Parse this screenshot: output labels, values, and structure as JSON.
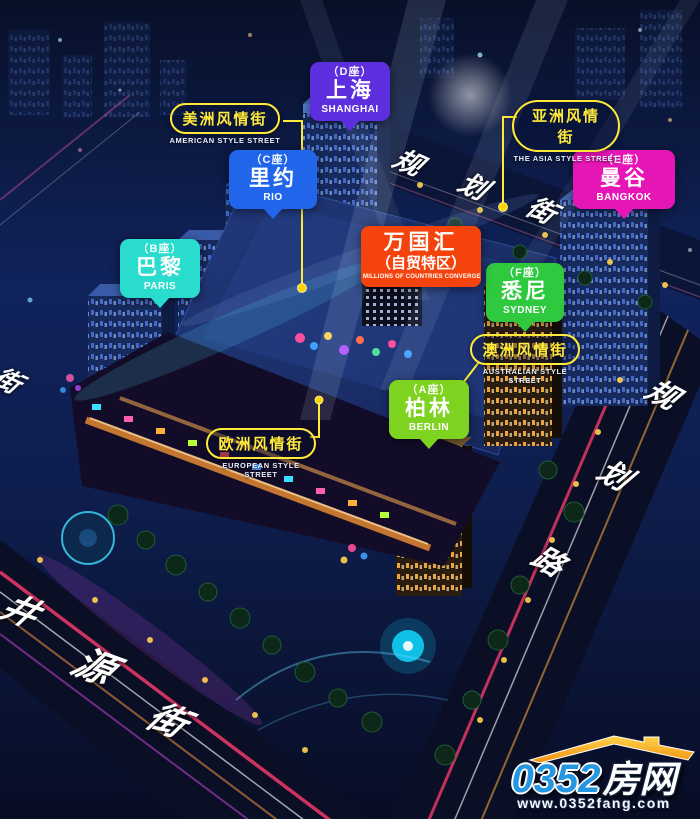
{
  "building_labels": {
    "shanghai": {
      "block": "（D座）",
      "name": "上海",
      "en": "SHANGHAI",
      "color": "#5c2ede"
    },
    "rio": {
      "block": "（C座）",
      "name": "里约",
      "en": "RIO",
      "color": "#2166ea"
    },
    "bangkok": {
      "block": "（E座）",
      "name": "曼谷",
      "en": "BANGKOK",
      "color": "#e615b5"
    },
    "paris": {
      "block": "（B座）",
      "name": "巴黎",
      "en": "PARIS",
      "color": "#29dccd"
    },
    "sydney": {
      "block": "（F座）",
      "name": "悉尼",
      "en": "SYDNEY",
      "color": "#2ec93e"
    },
    "berlin": {
      "block": "（A座）",
      "name": "柏林",
      "en": "BERLIN",
      "color": "#7ed321"
    }
  },
  "hub_label": {
    "title": "万国汇",
    "subtitle": "（自贸特区）",
    "en": "MILLIONS OF COUNTRIES CONVERGE",
    "color": "#f5430d"
  },
  "street_signs": {
    "american": {
      "zh": "美洲风情街",
      "en": "AMERICAN STYLE STREET"
    },
    "asia": {
      "zh": "亚洲风情街",
      "en": "THE ASIA STYLE STREET"
    },
    "australian": {
      "zh": "澳洲风情街",
      "en": "AUSTRALIAN STYLE STREET"
    },
    "european": {
      "zh": "欧洲风情街",
      "en": "EUROPEAN STYLE STREET"
    },
    "outline_color": "#ffe93a"
  },
  "road_names": {
    "planning_street": {
      "chars": [
        "规",
        "划",
        "街"
      ]
    },
    "planning_road": {
      "chars": [
        "规",
        "划",
        "路"
      ]
    },
    "jingyuan_street": {
      "chars": [
        "井",
        "源",
        "街"
      ]
    },
    "left_edge_partial": {
      "chars": [
        "街"
      ]
    }
  },
  "connectors": {
    "color": "#ffe93a",
    "dot_color": "#ffd400"
  },
  "watermark": {
    "brand_number": "0352",
    "brand_suffix": "房网",
    "url": "www.0352fang.com",
    "accent_blue": "#2596e0",
    "accent_orange": "#f9a825"
  }
}
